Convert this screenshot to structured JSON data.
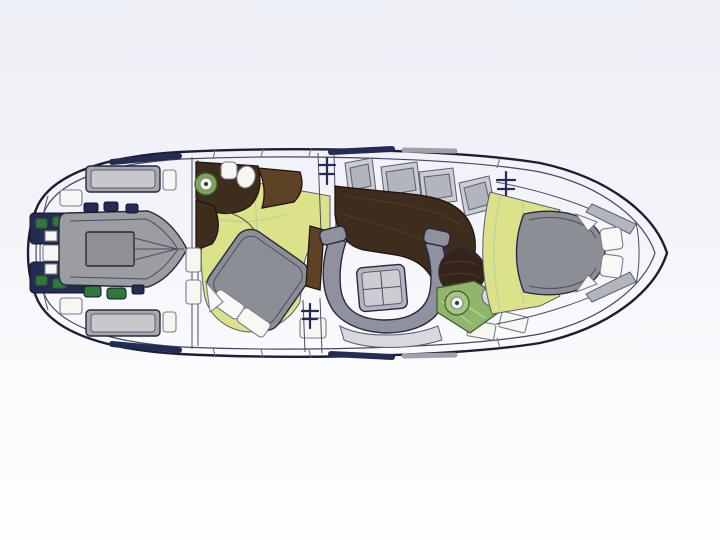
{
  "figure": {
    "kind": "yacht-floor-plan",
    "orientation": "bow-right"
  },
  "palette": {
    "background": "#f1f2f8",
    "hull_fill": "#ffffff",
    "hull_outline": "#1c1e33",
    "deck_white": "#ffffff",
    "pad_gray": "#a6a8ad",
    "pad_gray_inner": "#c6c8cc",
    "panel_gray": "#b3b5bc",
    "panel_gray_light": "#cbcdd2",
    "furniture_gray": "#8f919e",
    "bed_gray": "#8c8e96",
    "light_floor": "#d7d9de",
    "floor_yellow": "#dce289",
    "wood_dark": "#3e2c1c",
    "wood_mid": "#5d4226",
    "table_wood": "#35241a",
    "green_counter": "#8fb66b",
    "shower_green": "#7fa658",
    "sink_green_light": "#a9c584",
    "machinery_navy": "#232c52",
    "machinery_green": "#2f7a39",
    "white_fixture": "#f6f6f3",
    "stool_gray": "#d8d8d4",
    "pillow_white": "#f8f8f6",
    "dinghy_gray": "#9b9da1",
    "dinghy_floor_gray": "#8e9096"
  },
  "icons": {
    "companionway_steps": "steps-icon",
    "shower_drain": "shower-drain-icon",
    "galley_sink": "sink-icon"
  }
}
